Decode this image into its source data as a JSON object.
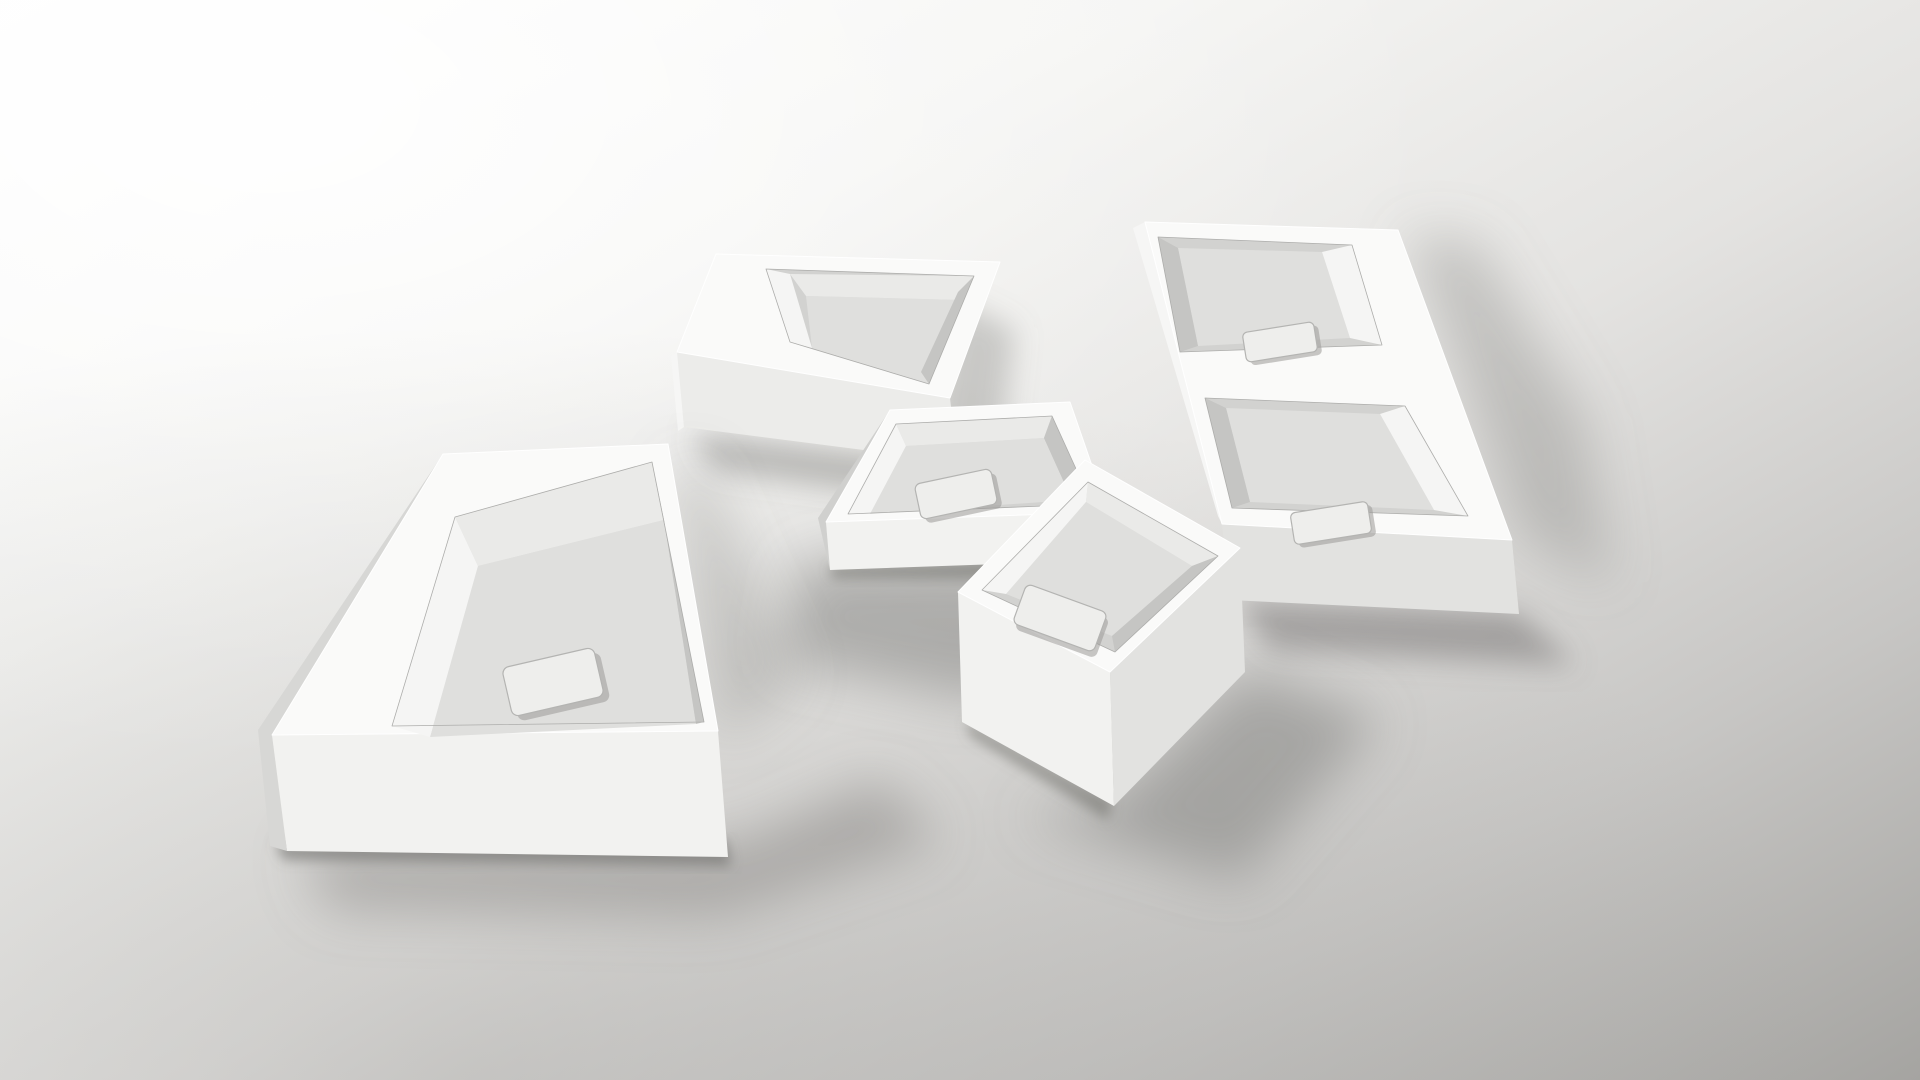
{
  "scene": {
    "title": "Five white rectangular countertop washbasins arranged on a gray studio floor",
    "object_count": "5"
  },
  "palette": {
    "bg_top_left": "#fefefe",
    "bg_upper": "#f5f5f3",
    "bg_mid": "#e4e3e1",
    "bg_lower": "#c7c6c4",
    "bg_bottom_right": "#a5a4a1",
    "floor_shade": "#8d8c89",
    "top_face": "#fafaf9",
    "front_face_bright": "#f2f2f0",
    "front_face": "#ececea",
    "front_face_dim": "#e2e2e0",
    "side_dark": "#d7d7d5",
    "side_bright": "#f6f6f5",
    "side_sliver": "#d0d0ce",
    "bowl_base": "#d2d2d0",
    "bowl_back": "#eaeae8",
    "bowl_bright": "#f5f5f4",
    "bowl_floor": "#dfdfdd",
    "bowl_dark": "#c5c5c3",
    "shadow": "#7e7d7a",
    "contact_shadow": "#686764",
    "drain_fill": "#eeeeec",
    "drain_stroke": "#b4b4b2",
    "drain_shadow": "#9a9997"
  },
  "units": {
    "left_basin": {
      "label": "large left basin with side deck",
      "top_face": "272,735 443,454 668,444 718,731",
      "front_face": "272,735 718,731 728,857 287,851",
      "side_face": "443,454 258,730 270,846 287,851 272,735",
      "bowl_opening": "392,726 455,517 652,462 704,722",
      "bowl_back": "455,517 652,462 664,520 478,566",
      "bowl_left": "392,726 455,517 478,566 430,737",
      "bowl_floor": "430,737 478,566 664,520 696,724",
      "bowl_right": "652,462 704,722 696,724 664,520",
      "drain": {
        "x": "506",
        "y": "657",
        "w": "94",
        "h": "50",
        "rx": "7",
        "transform": "rotate(-13 553 682)",
        "sx": "511",
        "sy": "663"
      },
      "shadow_far": "300,850 735,845 880,780 940,840 720,915 330,908",
      "shadow_side": "672,470 700,460 800,680 720,740",
      "shadow_contact": "275,842 726,840 731,866 283,860"
    },
    "top_center_basin": {
      "label": "top basin with left deck",
      "top_face": "677,352 716,254 1000,262 950,398",
      "front_face": "677,352 950,398 957,462 684,427",
      "side_face": "677,352 671,356 678,431 684,427",
      "bowl_opening": "766,269 974,276 929,384 790,342",
      "bowl_left": "766,269 790,342 812,348 790,274",
      "bowl_back": "790,274 974,276 960,300 806,296",
      "bowl_floor": "812,348 806,296 960,300 929,384",
      "bowl_right": "974,276 929,384 921,372 958,292",
      "shadow_far": "955,300 1015,330 1000,460 930,430",
      "shadow_contact": "690,432 958,466 975,505 715,470"
    },
    "center_basin": {
      "label": "small center basin",
      "top_face": "826,522 890,410 1070,402 1108,512",
      "front_face": "826,522 1108,512 1112,560 830,570",
      "side_face": "890,410 818,518 830,570 826,522",
      "bowl_opening": "848,514 896,424 1052,416 1092,504",
      "bowl_back": "896,424 1052,416 1044,438 906,446",
      "bowl_left": "848,514 896,424 906,446 870,514",
      "bowl_floor": "870,514 906,446 1044,438 1072,500",
      "bowl_right": "1052,416 1092,504 1072,500 1044,438",
      "drain": {
        "x": "917",
        "y": "476",
        "w": "78",
        "h": "36",
        "rx": "6",
        "transform": "rotate(-12 956 494)",
        "sx": "921",
        "sy": "481"
      },
      "shadow_far": "800,560 1108,556 1150,640 980,700 780,660",
      "shadow_contact": "830,566 1110,556 1112,580 832,578"
    },
    "right_double_basin": {
      "label": "long right unit with two bowls and bridge deck",
      "top_face": "1145,222 1398,230 1512,540 1222,524",
      "front_face": "1222,524 1512,540 1519,614 1230,600",
      "side_face": "1145,222 1133,228 1218,516 1222,524",
      "side_right": "1512,540 1519,614 1511,608 1502,546",
      "bowl1_opening": "1158,237 1352,245 1382,345 1180,352",
      "bowl1_right": "1352,245 1382,345 1350,338 1322,252",
      "bowl1_left": "1158,237 1180,352 1198,346 1178,248",
      "bowl1_floor": "1178,248 1198,346 1350,338 1322,252",
      "drain1": {
        "x": "1244",
        "y": "327",
        "w": "72",
        "h": "30",
        "rx": "5",
        "transform": "rotate(-9 1280 342)",
        "sx": "1248",
        "sy": "331"
      },
      "bowl2_opening": "1205,398 1405,406 1468,516 1232,508",
      "bowl2_right": "1405,406 1468,516 1434,510 1380,414",
      "bowl2_left": "1205,398 1232,508 1250,502 1226,408",
      "bowl2_floor": "1226,408 1250,502 1434,510 1380,414",
      "drain2": {
        "x": "1292",
        "y": "507",
        "w": "78",
        "h": "32",
        "rx": "5",
        "transform": "rotate(-9 1331 523)",
        "sx": "1296",
        "sy": "511"
      },
      "shadow_far": "1405,235 1520,535 1610,585 1585,420 1475,240",
      "shadow_contact": "1235,598 1518,612 1575,665 1270,650"
    },
    "bottom_center_basin": {
      "label": "bottom basin rotated diamond-wise",
      "top_face": "958,592 1085,460 1240,548 1110,672",
      "front_left_face": "958,592 1110,672 1114,806 962,722",
      "front_right_face": "1110,672 1240,548 1245,672 1114,806",
      "bowl_opening": "982,590 1088,482 1218,556 1115,652",
      "bowl_back": "1088,482 1218,556 1192,566 1086,502",
      "bowl_left": "982,590 1088,482 1086,502 1006,594",
      "bowl_floor": "1006,594 1086,502 1192,566 1112,636",
      "bowl_right": "1218,556 1115,652 1112,636 1192,566",
      "drain": {
        "x": "1017",
        "y": "597",
        "w": "86",
        "h": "42",
        "rx": "6",
        "transform": "rotate(20 1060 618)",
        "sx": "1021",
        "sy": "602"
      },
      "shadow_far": "1114,800 1248,668 1380,720 1240,880 1020,815",
      "shadow_contact": "966,720 1112,800 1108,820 970,736"
    }
  }
}
